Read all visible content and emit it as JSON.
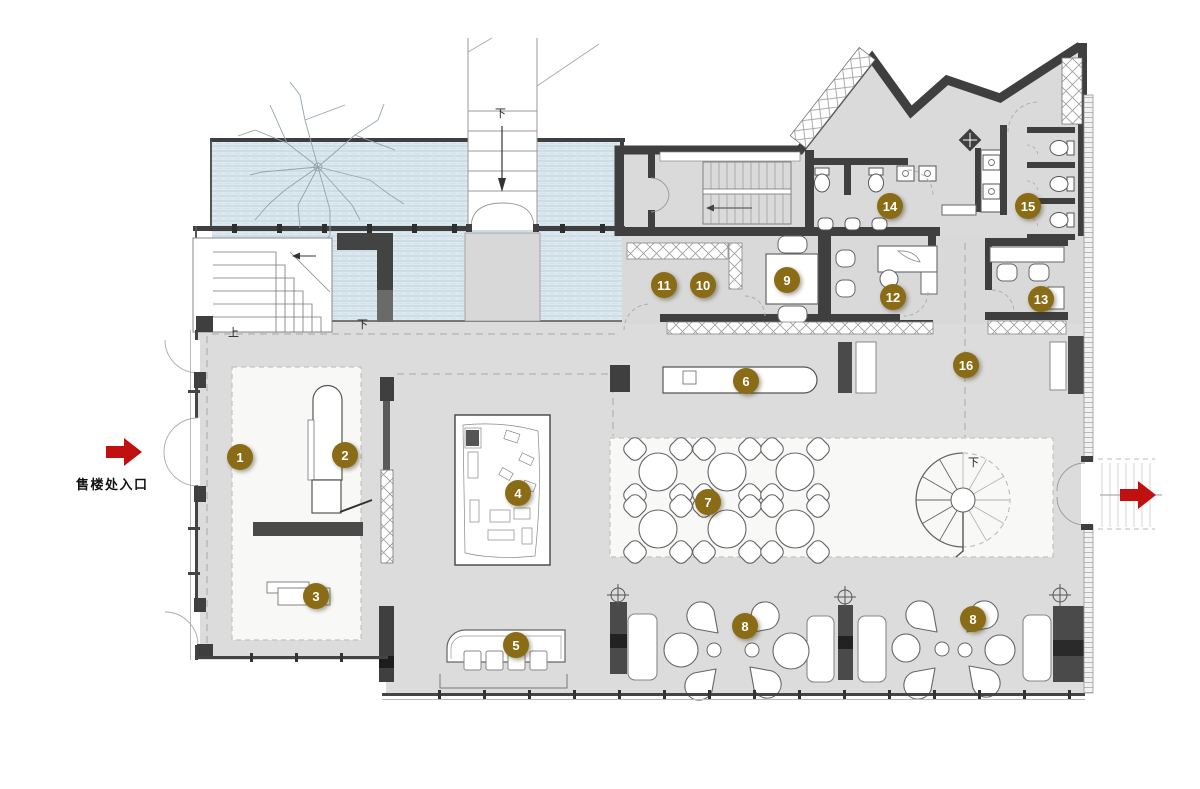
{
  "labels": {
    "entrance": "售楼处入口",
    "down": "下",
    "up": "上"
  },
  "markers": [
    {
      "label": "1"
    },
    {
      "label": "2"
    },
    {
      "label": "3"
    },
    {
      "label": "4"
    },
    {
      "label": "5"
    },
    {
      "label": "6"
    },
    {
      "label": "7"
    },
    {
      "label": "8"
    },
    {
      "label": "8"
    },
    {
      "label": "9"
    },
    {
      "label": "10"
    },
    {
      "label": "11"
    },
    {
      "label": "12"
    },
    {
      "label": "13"
    },
    {
      "label": "14"
    },
    {
      "label": "15"
    },
    {
      "label": "16"
    }
  ],
  "colors": {
    "marker_gold": "#8a6b16",
    "arrow_red": "#c11010",
    "water_blue": "#dde9ee",
    "wall_dark": "#3f3f3f",
    "floor_gray": "#dcdcdc",
    "zone_white": "#f8f8f6"
  }
}
